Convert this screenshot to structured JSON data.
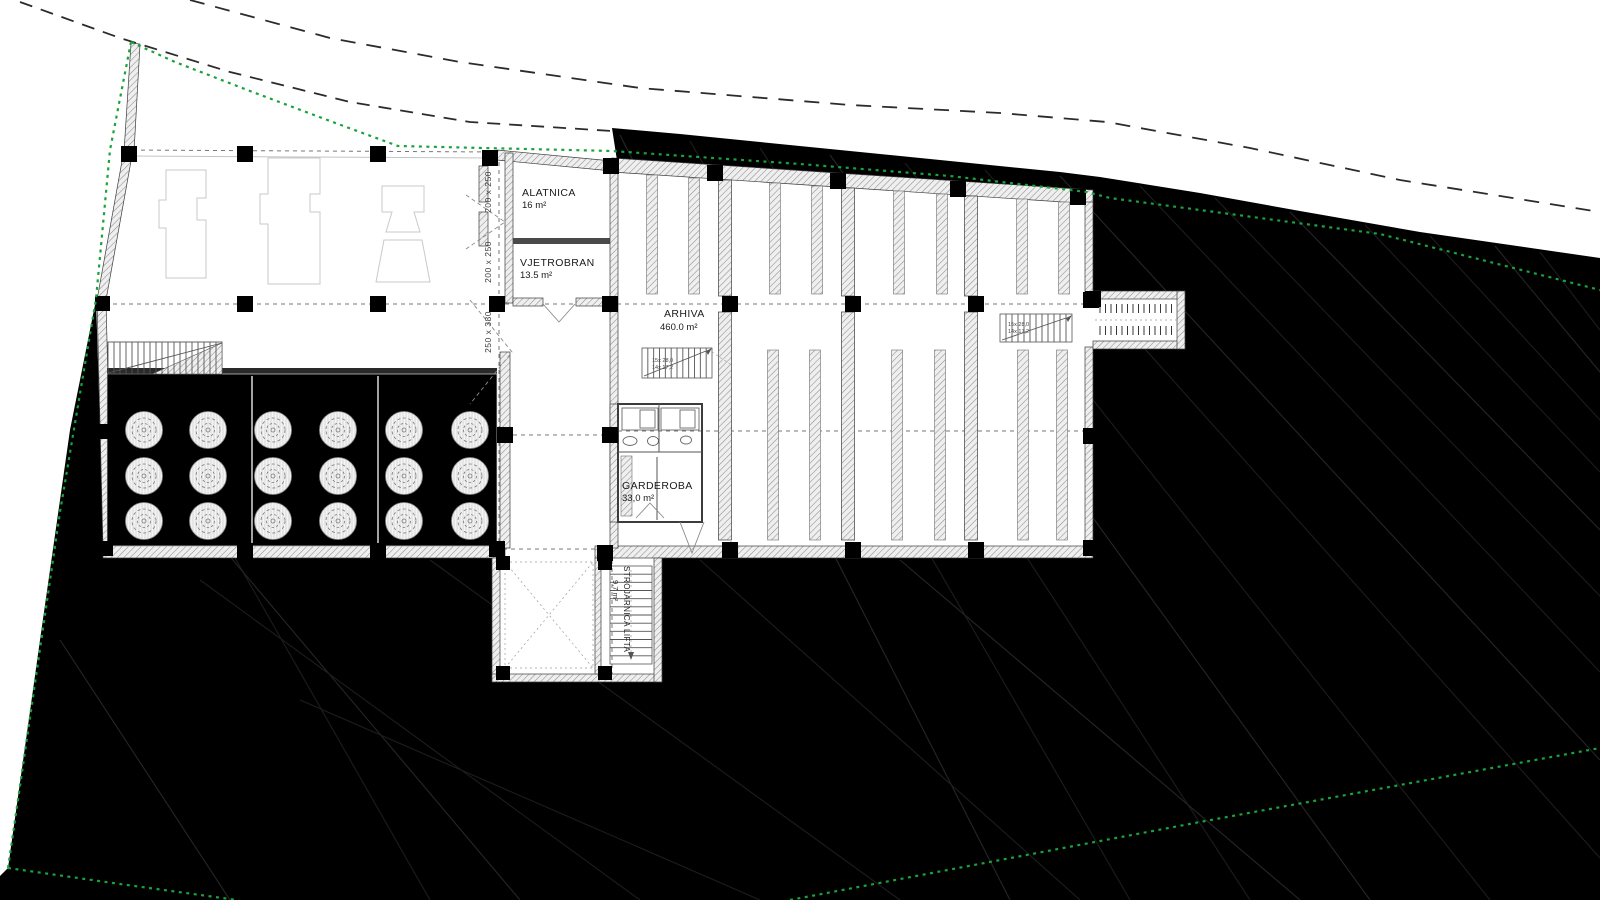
{
  "plan": {
    "rooms": {
      "alatnica": {
        "name": "ALATNICA",
        "area": "16 m²"
      },
      "vjetrobran": {
        "name": "VJETROBRAN",
        "area": "13.5 m²"
      },
      "arhiva": {
        "name": "ARHIVA",
        "area": "460.0 m²"
      },
      "garderoba": {
        "name": "GARDEROBA",
        "area": "33,0 m²"
      },
      "strojarnica": {
        "name": "STROJARNICA LIFTA",
        "area": "9,7 m²"
      }
    },
    "dimension_labels": [
      "200 x 250",
      "200 x 250",
      "250 x 380"
    ],
    "stair_notes": {
      "line1": "15x 28,0",
      "line2": "14x 17,2"
    },
    "colors": {
      "terrain": "#000000",
      "site_boundary_green": "#1aa23b",
      "contour_line": "#2b2b2b",
      "wall_hatch": "#8d8d8d"
    }
  }
}
